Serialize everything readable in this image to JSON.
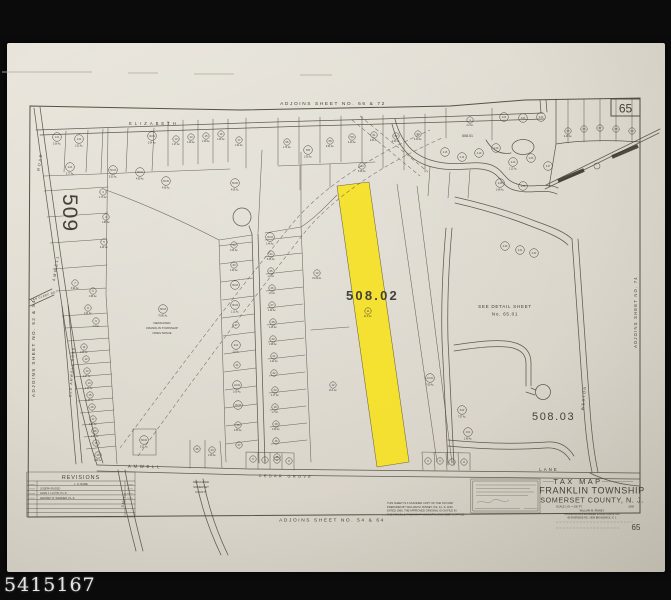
{
  "watermark": {
    "text": "5415167"
  },
  "colors": {
    "paper": "#ded9ce",
    "ink": "#45403a",
    "highlight": "#f7e11a",
    "frame": "#0b0b0b"
  },
  "map": {
    "labels": [
      {
        "t": "ADJOINS SHEET NO. 66 & 72",
        "x": 333,
        "y": 105,
        "s": 4.8,
        "ls": 1.6,
        "a": "middle",
        "n": "adjoins-top-label"
      },
      {
        "t": "ADJOINS SHEET NO. 54 & 64",
        "x": 332,
        "y": 521.5,
        "s": 4.8,
        "ls": 1.6,
        "a": "middle",
        "n": "adjoins-bottom-label"
      },
      {
        "t": "ADJOINS SHEET NO. 52 & 54",
        "x": 35,
        "y": 348,
        "s": 4.6,
        "ls": 1.4,
        "a": "middle",
        "r": -90,
        "n": "adjoins-left-label"
      },
      {
        "t": "ADJOINS SHEET NO. 74",
        "x": 637,
        "y": 312,
        "s": 4.2,
        "ls": 1.2,
        "a": "middle",
        "r": -90,
        "n": "adjoins-right-label"
      },
      {
        "t": "65",
        "x": 625.5,
        "y": 112.5,
        "s": 12,
        "a": "middle",
        "c": "#35312a",
        "n": "sheet-number-box-label"
      },
      {
        "t": "65",
        "x": 636,
        "y": 530,
        "s": 8,
        "a": "middle",
        "n": "sheet-number-bottom-label"
      },
      {
        "t": "509",
        "x": 63,
        "y": 213,
        "s": 21,
        "ls": 1,
        "a": "middle",
        "r": 90,
        "c": "#504a40",
        "n": "block-509-label"
      },
      {
        "t": "508.02",
        "x": 346,
        "y": 300,
        "s": 13,
        "ls": 2.2,
        "a": "start",
        "w": "bold",
        "c": "#2c2822",
        "n": "block-508-02-label"
      },
      {
        "t": "508.03",
        "x": 532,
        "y": 420,
        "s": 11,
        "ls": 1.6,
        "a": "start",
        "c": "#38332b",
        "n": "block-508-03-label"
      },
      {
        "t": "508.01",
        "x": 462,
        "y": 137,
        "s": 3.6,
        "a": "start",
        "n": "block-508-01-label"
      },
      {
        "t": "SEE DETAIL SHEET",
        "x": 505,
        "y": 308,
        "s": 4.6,
        "ls": 0.7,
        "a": "middle",
        "n": "see-detail-line1"
      },
      {
        "t": "No. 65.01",
        "x": 505,
        "y": 315.5,
        "s": 4.6,
        "ls": 0.7,
        "a": "middle",
        "n": "see-detail-line2"
      },
      {
        "t": "ELIZABETH",
        "x": 129,
        "y": 125,
        "s": 4.2,
        "ls": 3,
        "a": "start",
        "n": "street-elizabeth-label"
      },
      {
        "t": "ROAD",
        "x": 41,
        "y": 162,
        "s": 3.8,
        "ls": 1.8,
        "a": "middle",
        "r": -81,
        "n": "street-amwell-road-upper-label"
      },
      {
        "t": "AMWELL",
        "x": 57,
        "y": 268,
        "s": 3.8,
        "ls": 1.8,
        "a": "middle",
        "r": -81,
        "n": "street-amwell-road-lower-label"
      },
      {
        "t": "OLD AMWELL ROAD",
        "x": 73,
        "y": 372,
        "s": 3.4,
        "ls": 1.2,
        "a": "middle",
        "r": -86,
        "n": "street-old-amwell-label"
      },
      {
        "t": "VAN CLEEF RD.",
        "x": 44,
        "y": 297,
        "s": 3,
        "ls": 0.4,
        "a": "middle",
        "r": -18,
        "n": "street-van-cleef-label"
      },
      {
        "t": "AMWELL",
        "x": 145,
        "y": 468,
        "s": 4.4,
        "ls": 2.6,
        "a": "middle",
        "r": 1,
        "n": "street-amwell-bottom-label"
      },
      {
        "t": "CEDAR GROVE",
        "x": 286,
        "y": 477.5,
        "s": 3.8,
        "ls": 2.4,
        "a": "middle",
        "r": 1,
        "n": "street-cedar-grove-label"
      },
      {
        "t": "LANE",
        "x": 549,
        "y": 471,
        "s": 4.4,
        "ls": 2,
        "a": "middle",
        "n": "street-lane-label"
      },
      {
        "t": "WESTON",
        "x": 585,
        "y": 398,
        "s": 3.8,
        "ls": 1.4,
        "a": "middle",
        "r": -84,
        "n": "street-weston-label"
      },
      {
        "t": "SMITH",
        "x": 125,
        "y": 500,
        "s": 3.4,
        "ls": 1,
        "a": "middle",
        "r": -78,
        "n": "street-smith-label"
      },
      {
        "t": "DEDICATED",
        "x": 162,
        "y": 324,
        "s": 3,
        "a": "middle",
        "n": "open-space-note-1"
      },
      {
        "t": "FRANKLIN TOWNSHIP",
        "x": 162,
        "y": 329,
        "s": 3,
        "a": "middle",
        "n": "open-space-note-2"
      },
      {
        "t": "OPEN SPACE",
        "x": 162,
        "y": 334,
        "s": 3,
        "a": "middle",
        "n": "open-space-note-3"
      },
      {
        "t": "DEDICATED",
        "x": 201,
        "y": 483,
        "s": 2.8,
        "a": "middle",
        "n": "county-note-1"
      },
      {
        "t": "SOMERSET",
        "x": 201,
        "y": 488,
        "s": 2.8,
        "a": "middle",
        "n": "county-note-2"
      },
      {
        "t": "COUNTY",
        "x": 201,
        "y": 493,
        "s": 2.8,
        "a": "middle",
        "n": "county-note-3"
      },
      {
        "t": "TAX MAP",
        "x": 578,
        "y": 484,
        "s": 7.5,
        "ls": 2.4,
        "a": "middle",
        "c": "#3a352d",
        "n": "title-tax-map"
      },
      {
        "t": "FRANKLIN TOWNSHIP",
        "x": 592,
        "y": 493.5,
        "s": 9,
        "ls": 0.6,
        "a": "middle",
        "c": "#35302a",
        "n": "title-township"
      },
      {
        "t": "SOMERSET COUNTY, N. J.",
        "x": 592,
        "y": 502.5,
        "s": 7.2,
        "ls": 0.6,
        "a": "middle",
        "c": "#35302a",
        "n": "title-county"
      },
      {
        "t": "SCALE 1 IN. = 200 FT.",
        "x": 556,
        "y": 507.5,
        "s": 2.6,
        "a": "start",
        "n": "title-scale"
      },
      {
        "t": "1966",
        "x": 634,
        "y": 507.5,
        "s": 2.6,
        "a": "end",
        "n": "title-year"
      },
      {
        "t": "WILLIAM M. RINNEY",
        "x": 592,
        "y": 511.5,
        "s": 2.6,
        "a": "middle",
        "n": "title-surveyor-1"
      },
      {
        "t": "PROFESSIONAL ENGINEER & LAND SURVEYOR",
        "x": 592,
        "y": 515,
        "s": 2.4,
        "a": "middle",
        "n": "title-surveyor-2"
      },
      {
        "t": "45 RIVERSIDE RD., NEW BRUNSWICK, N. J.",
        "x": 592,
        "y": 518.4,
        "s": 2.4,
        "a": "middle",
        "n": "title-surveyor-3"
      },
      {
        "t": "THIS SHEET IS A SCANNED COPY OF THE TAX MAP",
        "x": 387,
        "y": 504,
        "s": 2.7,
        "a": "start",
        "n": "scan-note-1"
      },
      {
        "t": "PREPARED BY WILLIAM M. RINNEY, P.E. & L.S. AND",
        "x": 387,
        "y": 507.8,
        "s": 2.7,
        "a": "start",
        "n": "scan-note-2"
      },
      {
        "t": "DATED 1966. THE APPROVED ORIGINAL IS ON FILE IN",
        "x": 387,
        "y": 511.6,
        "s": 2.7,
        "a": "start",
        "n": "scan-note-3"
      },
      {
        "t": "THE FRANKLIN TOWNSHIP MUNICIPAL ENGINEER'S OFFICE.",
        "x": 387,
        "y": 515.4,
        "s": 2.7,
        "a": "start",
        "n": "scan-note-4"
      },
      {
        "t": "REVISIONS",
        "x": 81,
        "y": 479,
        "s": 5.4,
        "ls": 1,
        "a": "middle",
        "c": "#3a352d",
        "n": "revisions-title"
      },
      {
        "t": "L. G. RAME",
        "x": 81,
        "y": 485,
        "s": 2.6,
        "a": "middle",
        "n": "revision-row-1"
      },
      {
        "t": "JOSEPH RUSSO",
        "x": 40,
        "y": 489.6,
        "s": 2.6,
        "a": "start",
        "n": "revision-row-2"
      },
      {
        "t": "GLEN J. LLOYD, P.L.S.",
        "x": 40,
        "y": 494.2,
        "s": 2.6,
        "a": "start",
        "n": "revision-row-3"
      },
      {
        "t": "JEFFREY R. WARNER, P.L.S.",
        "x": 40,
        "y": 498.8,
        "s": 2.6,
        "a": "start",
        "n": "revision-row-4"
      }
    ],
    "lots": [
      [
        57,
        137,
        "1.01",
        "2.06 Ac."
      ],
      [
        79,
        139,
        "1.02",
        "1.52 Ac."
      ],
      [
        70,
        167,
        "2.01",
        "3.77 Ac."
      ],
      [
        113,
        170,
        "50.03",
        "5.53 Ac."
      ],
      [
        140,
        172,
        "50.04",
        "4.99 Ac."
      ],
      [
        166,
        181,
        "50.05",
        "4.08 Ac."
      ],
      [
        235,
        183,
        "50.06",
        "4.09 Ac."
      ],
      [
        152,
        136,
        "30.01",
        "2.04 Ac."
      ],
      [
        176,
        139,
        "13",
        "1.27 Ac."
      ],
      [
        191,
        137,
        "14",
        "1.29 Ac."
      ],
      [
        206,
        136,
        "15",
        "1.29 Ac."
      ],
      [
        221,
        134,
        "16",
        "1.29 Ac."
      ],
      [
        239,
        140,
        "17",
        "1.24 Ac."
      ],
      [
        287,
        142,
        "56",
        "1.74 Ac."
      ],
      [
        308,
        150,
        "57B",
        "1.09 Ac."
      ],
      [
        330,
        141,
        "58",
        "2.61 Ac."
      ],
      [
        352,
        137,
        "59",
        "2.40 Ac."
      ],
      [
        374,
        135,
        "61",
        "2.61 Ac."
      ],
      [
        396,
        136,
        "62",
        "2.63 Ac."
      ],
      [
        418,
        134,
        "63",
        "2.40 Ac."
      ],
      [
        362,
        166,
        "64",
        "3.08 Ac."
      ],
      [
        568,
        131,
        "65",
        "2.40 Ac."
      ],
      [
        584,
        129,
        "66",
        ""
      ],
      [
        600,
        128,
        "67",
        ""
      ],
      [
        616,
        129,
        "68",
        ""
      ],
      [
        632,
        131,
        "69",
        ""
      ],
      [
        470,
        120,
        "1",
        "2.2 Ac."
      ],
      [
        504,
        117,
        "2.04",
        ""
      ],
      [
        523,
        118,
        "2.03",
        ""
      ],
      [
        541,
        117,
        "2.02",
        ""
      ],
      [
        445,
        152,
        "2.15",
        ""
      ],
      [
        462,
        157,
        "2.14",
        ""
      ],
      [
        479,
        153,
        "2.19",
        ""
      ],
      [
        496,
        148,
        "2.20",
        ""
      ],
      [
        513,
        162,
        "2.23",
        "1.12 Ac."
      ],
      [
        531,
        158,
        "2.25",
        ""
      ],
      [
        548,
        166,
        "2.27",
        ""
      ],
      [
        500,
        183,
        "2.28",
        "1.08 Ac."
      ],
      [
        523,
        186,
        "2.26",
        ""
      ],
      [
        103,
        192,
        "3",
        "1.73 Ac."
      ],
      [
        106,
        217,
        "4",
        "1.89 Ac."
      ],
      [
        104,
        242,
        "5",
        "2.24 Ac."
      ],
      [
        93,
        291,
        "6",
        "1.98 Ac."
      ],
      [
        75,
        283,
        "7",
        "0.92 Ac."
      ],
      [
        88,
        308,
        "8",
        "1.04 Ac."
      ],
      [
        96,
        321,
        "9",
        "2.3 Ac."
      ],
      [
        84,
        347,
        "11",
        "1.06 Ac."
      ],
      [
        86,
        359,
        "12",
        ""
      ],
      [
        87,
        371,
        "13",
        "1.27 Ac."
      ],
      [
        89,
        383,
        "14",
        "1.12 Ac."
      ],
      [
        90,
        395,
        "15",
        "1.30 Ac."
      ],
      [
        92,
        407,
        "16",
        ""
      ],
      [
        93,
        419,
        "17",
        "0.80 Ac."
      ],
      [
        95,
        431,
        "18",
        "1.14 Ac."
      ],
      [
        96,
        443,
        "19",
        ""
      ],
      [
        98,
        455,
        "20",
        "1.24 Ac."
      ],
      [
        234,
        245,
        "50",
        "1.04 Ac."
      ],
      [
        234,
        265,
        "34",
        "1.32 Ac."
      ],
      [
        235,
        285,
        "35.03",
        ""
      ],
      [
        235,
        305,
        "36.03",
        "1.12 Ac."
      ],
      [
        236,
        325,
        "37",
        ""
      ],
      [
        236,
        345,
        "9.01",
        "1.0 Ac."
      ],
      [
        237,
        365,
        "41",
        ""
      ],
      [
        237,
        385,
        "43.02",
        "1.09 Ac."
      ],
      [
        238,
        405,
        "45.03",
        ""
      ],
      [
        238,
        425,
        "46",
        "1.53 Ac."
      ],
      [
        239,
        445,
        "47",
        ""
      ],
      [
        270,
        237,
        "30.03",
        "1.46 Ac."
      ],
      [
        271,
        254,
        "24",
        "0.46 Ac."
      ],
      [
        271,
        271,
        "25",
        "1.0 Ac."
      ],
      [
        272,
        288,
        "26",
        "1.0 Ac."
      ],
      [
        272,
        305,
        "27",
        "1.32 Ac."
      ],
      [
        273,
        322,
        "28",
        "1.46 Ac."
      ],
      [
        273,
        339,
        "29",
        "1.68 Ac."
      ],
      [
        274,
        356,
        "21",
        "1.22 Ac."
      ],
      [
        274,
        373,
        "22",
        ""
      ],
      [
        275,
        390,
        "23",
        "2.17 Ac."
      ],
      [
        275,
        407,
        "19",
        "1.7 Ac."
      ],
      [
        276,
        424,
        "18",
        "1.00 Ac."
      ],
      [
        276,
        441,
        "16",
        ""
      ],
      [
        277,
        457,
        "15",
        ""
      ],
      [
        163,
        309,
        "68.03",
        "75.80 Ac."
      ],
      [
        144,
        440,
        "68.02",
        "2.02 Ac."
      ],
      [
        317,
        273,
        "10",
        "15.29 Ac."
      ],
      [
        333,
        385,
        "12",
        "16.4 Ac."
      ],
      [
        368,
        311,
        "11",
        "21.9 Ac."
      ],
      [
        430,
        378,
        "10.02",
        "7.00 Ac."
      ],
      [
        462,
        410,
        "3.02",
        "7.57 Ac."
      ],
      [
        468,
        432,
        "3.01",
        "1.99 Ac."
      ],
      [
        197,
        449,
        "45",
        ""
      ],
      [
        212,
        450,
        "44",
        "1.53 Ac."
      ],
      [
        253,
        459,
        "5",
        ""
      ],
      [
        265,
        460,
        "6",
        ""
      ],
      [
        277,
        460,
        "7",
        ""
      ],
      [
        289,
        461,
        "8",
        ""
      ],
      [
        428,
        461,
        "5",
        ""
      ],
      [
        440,
        461,
        "6",
        ""
      ],
      [
        452,
        462,
        "7",
        ""
      ],
      [
        464,
        462,
        "8",
        ""
      ],
      [
        505,
        246,
        "2.30",
        ""
      ],
      [
        520,
        250,
        "2.31",
        ""
      ],
      [
        534,
        253,
        "2.32",
        ""
      ]
    ]
  }
}
